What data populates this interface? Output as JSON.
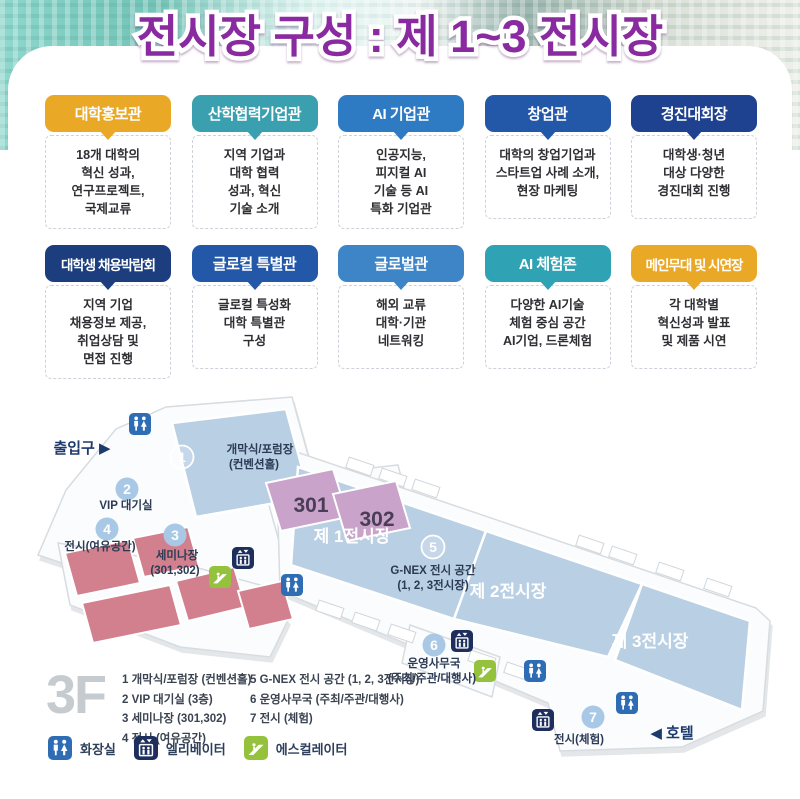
{
  "title": "전시장 구성 : 제 1~3 전시장",
  "cards": {
    "row1": [
      {
        "label": "대학홍보관",
        "color": "#EAA827",
        "body": "18개 대학의\n혁신 성과,\n연구프로젝트,\n국제교류"
      },
      {
        "label": "산학협력기업관",
        "color": "#3A9FAE",
        "body": "지역 기업과\n대학 협력\n성과, 혁신\n기술 소개"
      },
      {
        "label": "AI 기업관",
        "color": "#2F7BC3",
        "body": "인공지능,\n피지컬 AI\n기술 등 AI\n특화 기업관"
      },
      {
        "label": "창업관",
        "color": "#2357A8",
        "body": "대학의 창업기업과\n스타트업 사례 소개,\n현장 마케팅"
      },
      {
        "label": "경진대회장",
        "color": "#1E4190",
        "body": "대학생·청년\n대상 다양한\n경진대회 진행"
      }
    ],
    "row2": [
      {
        "label": "대학생 채용박람회",
        "color": "#1D3E7E",
        "body": "지역 기업\n채용정보 제공,\n취업상담 및\n면접 진행"
      },
      {
        "label": "글로컬 특별관",
        "color": "#2357A8",
        "body": "글로컬 특성화\n대학 특별관\n구성"
      },
      {
        "label": "글로벌관",
        "color": "#3D85C6",
        "body": "해외 교류\n대학·기관\n네트워킹"
      },
      {
        "label": "AI 체험존",
        "color": "#2FA3B4",
        "body": "다양한 AI기술\n체험 중심 공간\nAI기업, 드론체험"
      },
      {
        "label": "메인무대 및 시연장",
        "color": "#EAA827",
        "body": "각 대학별\n혁신성과 발표\n및 제품 시연"
      }
    ]
  },
  "floor_plan": {
    "floor_label": "3F",
    "entrance_label": "출입구 ▶",
    "hotel_label": "◀ 호텔",
    "numbers": [
      "1",
      "2",
      "3",
      "4",
      "5",
      "6",
      "7"
    ],
    "areas": {
      "convention": "개막식/포럼장",
      "convention_sub": "(컨벤션홀)",
      "vip": "VIP 대기실",
      "room301": "301",
      "room302": "302",
      "seminar": "세미나장",
      "seminar_sub": "(301,302)",
      "spare": "전시(여유공간)",
      "hall1": "제 1전시장",
      "hall2": "제 2전시장",
      "hall3": "제 3전시장",
      "gnex": "G-NEX 전시 공간",
      "gnex_sub": "(1, 2, 3전시장)",
      "office": "운영사무국",
      "office_sub": "(주최/주관/대행사)",
      "experience": "전시(체험)"
    },
    "legend": {
      "col1": [
        "1 개막식/포럼장 (컨벤션홀)",
        "2 VIP 대기실 (3층)",
        "3 세미나장 (301,302)",
        "4 전시 (여유공간)"
      ],
      "col2": [
        "5 G-NEX 전시 공간 (1, 2, 3전시장)",
        "6 운영사무국 (주최/주관/대행사)",
        "7 전시 (체험)"
      ],
      "icons": [
        {
          "name": "restroom",
          "label": "화장실"
        },
        {
          "name": "elevator",
          "label": "엘리베이터"
        },
        {
          "name": "escalator",
          "label": "에스컬레이터"
        }
      ]
    }
  },
  "colors": {
    "title": "#8A2AA0",
    "hall_blue": "#B9CFE4",
    "room_purple": "#C9A3C9",
    "room_red": "#D2808D",
    "number_circle": "#A9C8E5",
    "restroom_icon": "#2E6DB4",
    "elevator_icon": "#1E2F5E",
    "escalator_icon": "#95C23D",
    "floor_label_gray": "#C6CBD0"
  }
}
